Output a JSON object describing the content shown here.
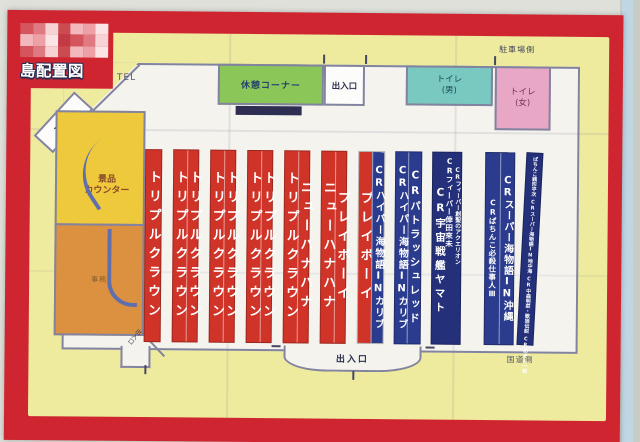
{
  "header": {
    "title": "島配置図",
    "censor_palette": [
      "#d5555e",
      "#eda0a6",
      "#f7d2d4",
      "#c23a44",
      "#f3b8bc",
      "#e07a82",
      "#fbe4e5",
      "#cc4a52"
    ]
  },
  "map": {
    "facilities": {
      "entrance_top_left": "出入口",
      "tel": "TEL",
      "rest_corner": "休憩コーナー",
      "entrance_top": "出入口",
      "toilet_men": {
        "line1": "トイレ",
        "line2": "(男)"
      },
      "toilet_women": {
        "line1": "トイレ",
        "line2": "(女)"
      },
      "parking_side": "駐車場側",
      "prize_counter": {
        "line1": "景品",
        "line2": "カウンター"
      },
      "office": "事務",
      "entrance_bottom_left": "出入口",
      "entrance_bottom": "出入口",
      "road_side": "国道側"
    },
    "islands": [
      {
        "x": 115,
        "w": 17,
        "bg": "red",
        "cols": [
          {
            "text": "トリプルクラウン",
            "cls": "L"
          }
        ]
      },
      {
        "x": 143,
        "w": 26,
        "bg": "red",
        "cols": [
          {
            "text": "トリプルクラウン",
            "cls": "L"
          },
          {
            "text": "トリプルクラウン",
            "cls": "L"
          }
        ]
      },
      {
        "x": 180,
        "w": 26,
        "bg": "red",
        "cols": [
          {
            "text": "トリプルクラウン",
            "cls": "L"
          },
          {
            "text": "トリプルクラウン",
            "cls": "L"
          }
        ]
      },
      {
        "x": 217,
        "w": 26,
        "bg": "red",
        "cols": [
          {
            "text": "トリプルクラウン",
            "cls": "L"
          },
          {
            "text": "トリプルクラウン",
            "cls": "L"
          }
        ]
      },
      {
        "x": 254,
        "w": 26,
        "bg": "red",
        "cols": [
          {
            "text": "トリプルクラウン",
            "cls": "L"
          },
          {
            "text": "ニューハナハナ",
            "cls": "L"
          }
        ]
      },
      {
        "x": 291,
        "w": 26,
        "bg": "red",
        "cols": [
          {
            "text": "ニューハナハナ",
            "cls": "L"
          },
          {
            "text": "プレイボーイ",
            "cls": "L"
          }
        ]
      },
      {
        "x": 328,
        "w": 27,
        "cols": [
          {
            "text": "プレイボーイ",
            "cls": "L",
            "bg": "red"
          },
          {
            "text": "CRハイパー海物語INカリブ",
            "cls": "M",
            "bg": "navy"
          }
        ]
      },
      {
        "x": 365,
        "w": 27,
        "bg": "navy",
        "cols": [
          {
            "text": "CRハイパー海物語INカリブ",
            "cls": "M"
          },
          {
            "text": "CRパトラッシュレッド",
            "cls": "M2"
          }
        ]
      },
      {
        "x": 402,
        "w": 30,
        "bg": "navy2",
        "free": [
          {
            "text": "CR宇宙戦艦ヤマト",
            "cls": "M2",
            "style": "left:2px;top:34px"
          },
          {
            "text": "CRフィーバー倖田來未",
            "cls": "S",
            "style": "right:8px;top:4px"
          },
          {
            "text": "CRフィーバー創聖のアクエリオン",
            "cls": "XS",
            "style": "right:1px;top:14px"
          }
        ]
      },
      {
        "x": 455,
        "w": 30,
        "bg": "navy",
        "cols": [
          {
            "text": "CRぱちんこ必殺仕事人Ⅲ",
            "cls": "S"
          },
          {
            "text": "CRスーパー海物語IN沖縄",
            "cls": "M3"
          }
        ]
      },
      {
        "x": 492,
        "w": 17,
        "bg": "navy2",
        "rot": 2.5,
        "stack": [
          "ぱちんこ銭形平次",
          "CRスーパー海物語IN地中海",
          "CR中森明菜・歌姫伝説",
          "CRめぞん一刻"
        ]
      }
    ]
  }
}
